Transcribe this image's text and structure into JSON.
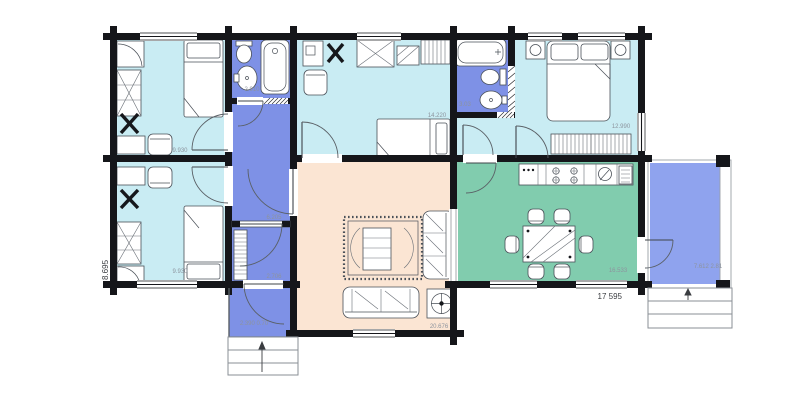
{
  "plan": {
    "type": "house-floor-plan",
    "rooms": [
      {
        "name": "bedroom-top-left",
        "label": "9.930"
      },
      {
        "name": "bedroom-bottom-left",
        "label": "9.930"
      },
      {
        "name": "bathroom-left",
        "label": "2.910"
      },
      {
        "name": "hallway",
        "label": "6.205"
      },
      {
        "name": "closet",
        "label": "2.706"
      },
      {
        "name": "entry-hall",
        "label": "2.390 0.70"
      },
      {
        "name": "bedroom-middle",
        "label": "14.220"
      },
      {
        "name": "bathroom-right",
        "label": "3.03"
      },
      {
        "name": "bedroom-master",
        "label": "12.990"
      },
      {
        "name": "living-room",
        "label": "20.676"
      },
      {
        "name": "dining-kitchen",
        "label": "16.533"
      },
      {
        "name": "terrace",
        "label": "7.612 2.81"
      }
    ],
    "overall_width_label": "17 595",
    "overall_height_label": "8.695"
  },
  "colors": {
    "bedroom_fill": "#c9ecf3",
    "wet_fill": "#7e91e6",
    "terrace_fill": "#8fa3ee",
    "living_fill": "#fbe5d3",
    "dining_fill": "#81ccae",
    "wall": "#15161a",
    "label": "#8d949e"
  }
}
